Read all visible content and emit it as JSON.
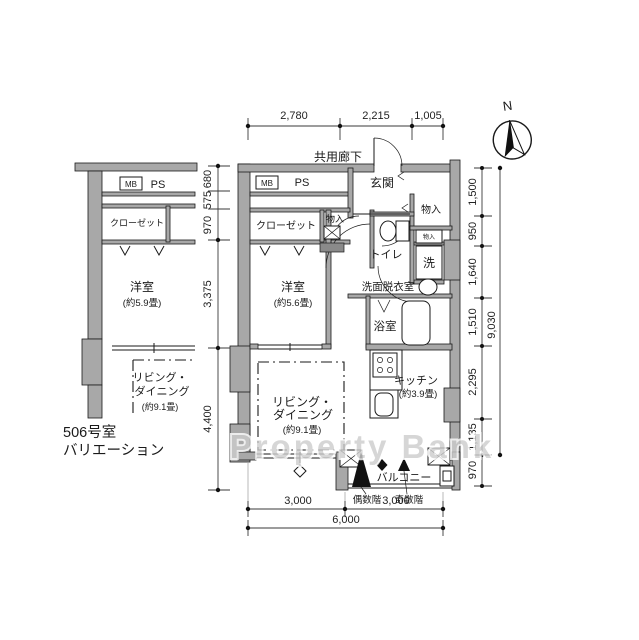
{
  "watermark": "Property Bank",
  "compass": {
    "north": "N"
  },
  "labels": {
    "corridor": "共用廊下",
    "entrance": "玄関",
    "ps": "PS",
    "mb": "MB",
    "storage": "物入",
    "closet": "クローゼット",
    "toilet": "トイレ",
    "washer": "洗",
    "washroom": "洗面脱衣室",
    "bath": "浴室",
    "bedroom": "洋室",
    "bedroom_size": "(約5.6畳)",
    "kitchen": "キッチン",
    "kitchen_size": "(約3.9畳)",
    "living_1": "リビング・",
    "living_2": "ダイニング",
    "living_size": "(約9.1畳)",
    "balcony": "バルコニー",
    "even_floor": "偶数階",
    "odd_floor": "奇数階"
  },
  "variation": {
    "caption_1": "506号室",
    "caption_2": "バリエーション",
    "ps": "PS",
    "mb": "MB",
    "closet": "クローゼット",
    "bedroom": "洋室",
    "bedroom_size": "(約5.9畳)",
    "living_1": "リビング・",
    "living_2": "ダイニング",
    "living_size": "(約9.1畳)"
  },
  "dimensions": {
    "top": [
      "2,780",
      "2,215",
      "1,005"
    ],
    "right": [
      "1,500",
      "950",
      "1,640",
      "1,510",
      "2,295",
      "1,135",
      "970"
    ],
    "right_total": "9,030",
    "left": [
      "680",
      "575",
      "970",
      "3,375",
      "4,400"
    ],
    "bottom": [
      "3,000",
      "3,000"
    ],
    "bottom_total": "6,000"
  },
  "colors": {
    "wall": "#a8a8a8",
    "line": "#1a1a1a",
    "watermark": "#cccccc"
  }
}
